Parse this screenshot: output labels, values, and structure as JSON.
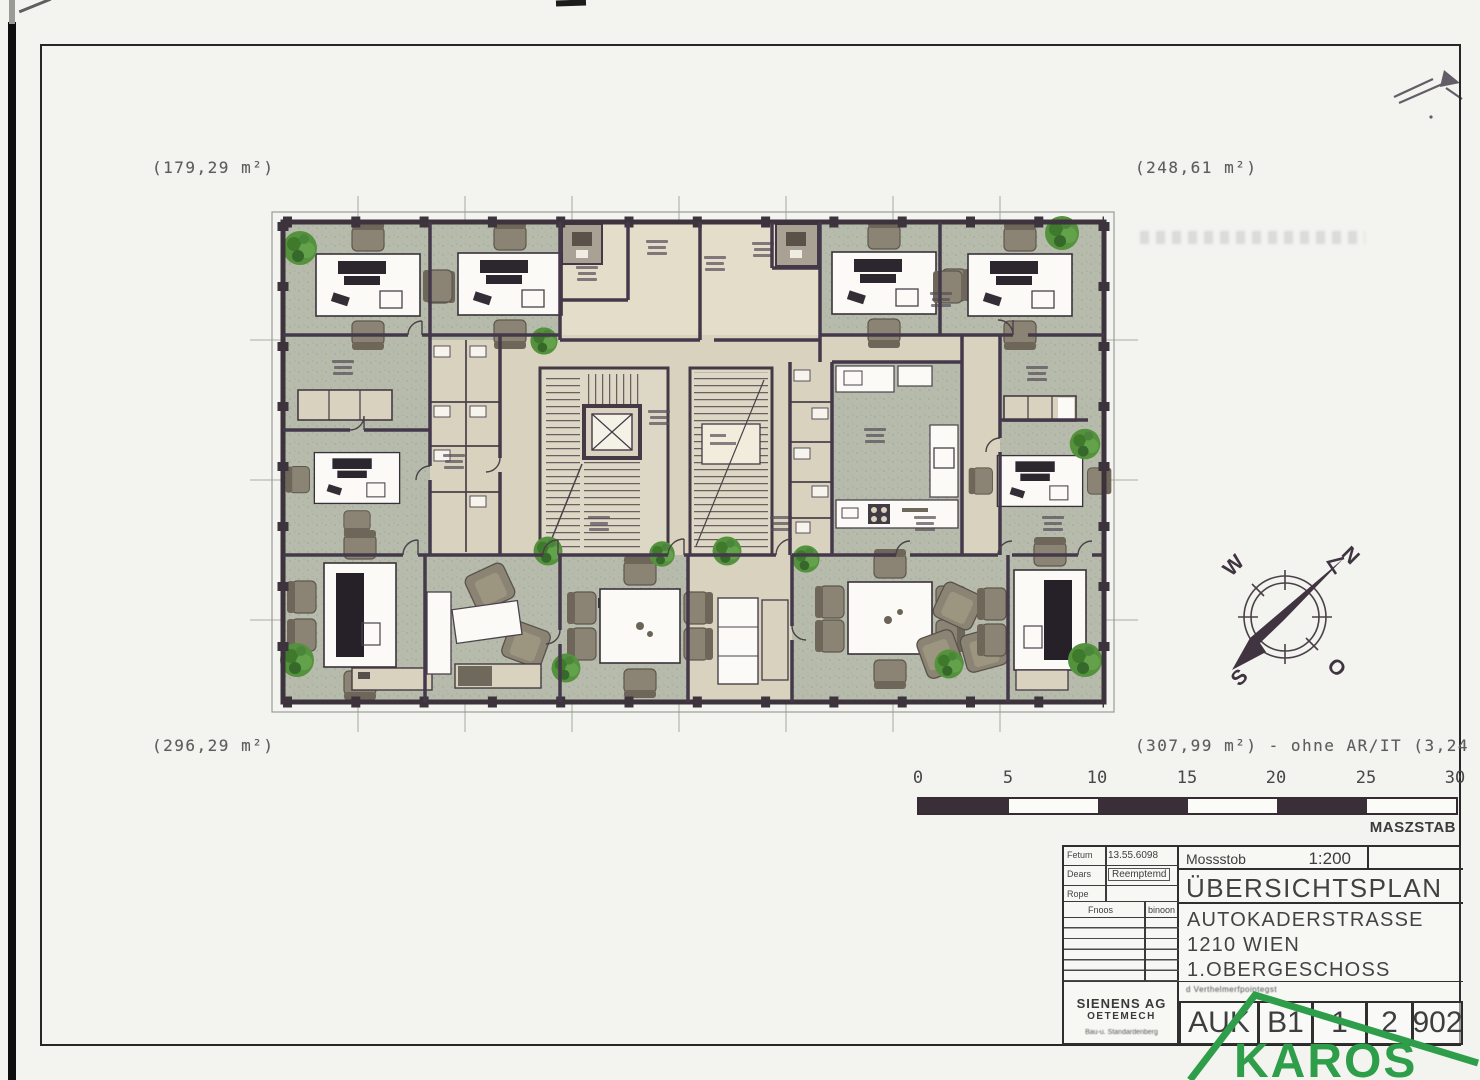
{
  "colors": {
    "paper": "#f3f3f0",
    "frame": "#262626",
    "wall": "#443a45",
    "floorGreen": "#b6bbac",
    "corridor": "#d8d2bf",
    "roomLight": "#e3ddca",
    "stair": "#ddd7c5",
    "white": "#fbfaf6",
    "chair": "#8b8475",
    "plant": "#55923d",
    "barDark": "#3a2e38",
    "ink": "#3f3f3f",
    "logoGreen": "#2f9e4a"
  },
  "plan": {
    "area_top_left": "(179,29 m²)",
    "area_top_right": "(248,61 m²)",
    "area_bottom_left": "(296,29 m²)",
    "area_bottom_right": "(307,99 m²) - ohne AR/IT (3,24 m"
  },
  "compass": {
    "n": "N",
    "w": "W",
    "s": "S",
    "o": "O"
  },
  "scale_bar": {
    "ticks": [
      "0",
      "5",
      "10",
      "15",
      "20",
      "25",
      "30"
    ],
    "label": "MASZSTAB"
  },
  "title_block": {
    "meta": [
      {
        "label": "Fetum",
        "value": "13.55.6098"
      },
      {
        "label": "Dears",
        "value": "Reemptemd"
      },
      {
        "label": "Rope",
        "value": ""
      }
    ],
    "rev_left": "Fnoos",
    "rev_right": "binoon",
    "company_line1": "SIENENS AG",
    "company_line2": "OETEMECH",
    "company_line3": "Bau-u. Standardenberg",
    "scale_label": "Mossstob",
    "scale_value": "1:200",
    "title": "ÜBERSICHTSPLAN",
    "address1": "AUTOKADERSTRASSE",
    "address2": "1210 WIEN",
    "address3": "1.OBERGESCHOSS",
    "note": "d Verthelmerfpointegst",
    "codes": [
      "AUK",
      "B1",
      "1",
      "2",
      "902"
    ]
  },
  "logo": {
    "text": "KAROS"
  }
}
